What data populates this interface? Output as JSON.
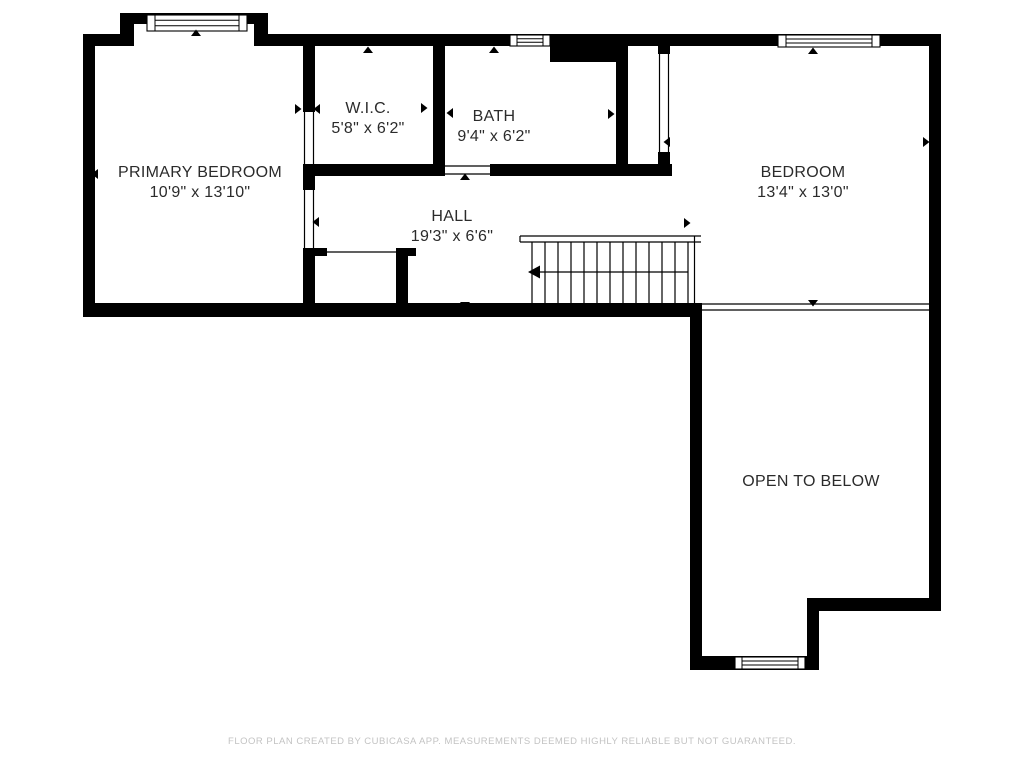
{
  "rooms": [
    {
      "name": "PRIMARY BEDROOM",
      "dims": "10'9\" x 13'10\""
    },
    {
      "name": "W.I.C.",
      "dims": "5'8\" x 6'2\""
    },
    {
      "name": "BATH",
      "dims": "9'4\" x 6'2\""
    },
    {
      "name": "HALL",
      "dims": "19'3\" x 6'6\""
    },
    {
      "name": "BEDROOM",
      "dims": "13'4\" x 13'0\""
    },
    {
      "name": "OPEN TO BELOW",
      "dims": ""
    }
  ],
  "footer": {
    "disclaimer": "FLOOR PLAN CREATED BY CUBICASA APP. MEASUREMENTS DEEMED HIGHLY RELIABLE BUT NOT GUARANTEED."
  },
  "colors": {
    "wall": "#000000",
    "label_text": "#2b2b2b",
    "footer_text": "#c3c3c3",
    "background": "#ffffff"
  }
}
